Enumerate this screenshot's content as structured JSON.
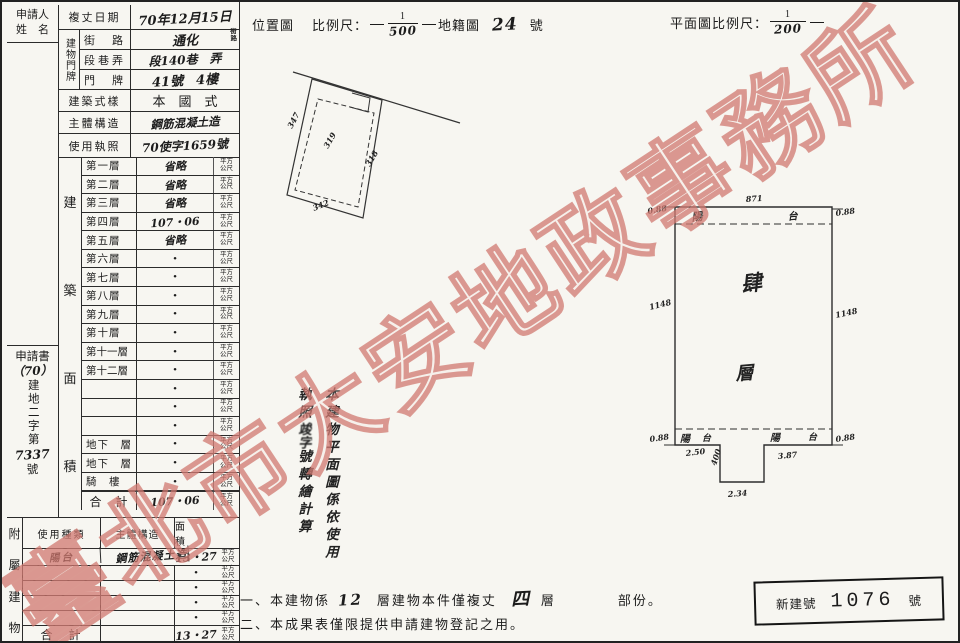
{
  "watermark": {
    "text": "臺北市大安地政事務所",
    "color": "#ce746c"
  },
  "header_table": {
    "applicant_l1": "申請人",
    "applicant_l2": "姓　名",
    "survey_date_label": "複丈日期",
    "survey_date_value": "70年12月15日",
    "doorplate_label": "建物門牌",
    "street_label": "街　路",
    "street_value": "通化",
    "street_unit_l1": "街",
    "street_unit_l2": "路",
    "section_label": "段巷弄",
    "section_value": "段140巷　弄",
    "number_label": "門　牌",
    "number_value": "41號　4樓",
    "style_label": "建築式樣",
    "style_value": "本　國　式",
    "structure_label": "主體構造",
    "structure_value": "鋼筋混凝土造",
    "license_label": "使用執照",
    "license_value": "70使字1659號"
  },
  "application": {
    "line1": "申請書",
    "line2": "（70）",
    "vertical_chars": "建地二字第",
    "number": "7337",
    "suffix": "號"
  },
  "floors_table": {
    "side_label_chars": [
      "建",
      "築",
      "面",
      "積"
    ],
    "unit_l1": "平方",
    "unit_l2": "公尺",
    "rows": [
      {
        "label": "第一層",
        "value": "省略"
      },
      {
        "label": "第二層",
        "value": "省略"
      },
      {
        "label": "第三層",
        "value": "省略"
      },
      {
        "label": "第四層",
        "value": "107・06"
      },
      {
        "label": "第五層",
        "value": "省略"
      },
      {
        "label": "第六層",
        "value": "•"
      },
      {
        "label": "第七層",
        "value": "•"
      },
      {
        "label": "第八層",
        "value": "•"
      },
      {
        "label": "第九層",
        "value": "•"
      },
      {
        "label": "第十層",
        "value": "•"
      },
      {
        "label": "第十一層",
        "value": "•"
      },
      {
        "label": "第十二層",
        "value": "•"
      },
      {
        "label": "",
        "value": "•"
      },
      {
        "label": "",
        "value": "•"
      },
      {
        "label": "",
        "value": "•"
      },
      {
        "label": "地下　層",
        "value": "•"
      },
      {
        "label": "地下　層",
        "value": "•"
      },
      {
        "label": "騎　樓",
        "value": "•"
      }
    ],
    "total_label": "合　計",
    "total_value": "107・06"
  },
  "annex_table": {
    "side_label_chars": [
      "附",
      "屬",
      "建",
      "物"
    ],
    "col_use": "使用種類",
    "col_structure": "主體構造",
    "col_area": "面　　積",
    "rows": [
      {
        "use": "陽台",
        "structure": "鋼筋混凝土造",
        "area": "13・27"
      },
      {
        "use": "",
        "structure": "",
        "area": "•"
      },
      {
        "use": "",
        "structure": "",
        "area": "•"
      },
      {
        "use": "",
        "structure": "",
        "area": "•"
      },
      {
        "use": "",
        "structure": "",
        "area": "•"
      }
    ],
    "total_label": "合　計",
    "total_area": "13・27"
  },
  "location_map": {
    "title": "位置圖",
    "scale_label": "比例尺：",
    "scale_numerator": "1",
    "scale_denominator": "500",
    "cadastre_label": "地籍圖",
    "cadastre_number": "24",
    "cadastre_suffix": "號",
    "parcel_left": "347",
    "parcel_center": "319",
    "parcel_right": "318",
    "parcel_bottom": "342"
  },
  "floor_plan": {
    "scale_label": "平面圖比例尺：",
    "scale_numerator": "1",
    "scale_denominator": "200",
    "dim_top": "871",
    "dim_top_left": "0.88",
    "dim_top_right": "0.88",
    "dim_side_left": "1148",
    "dim_side_right": "1148",
    "dim_bottom_left": "0.88",
    "dim_bottom_right": "0.88",
    "dim_strip_left": "2.50",
    "dim_strip_right": "3.87",
    "dim_protrusion_side": "400",
    "dim_protrusion_bottom": "2.34",
    "balcony_top_left": "陽",
    "balcony_top_right": "台",
    "balcony_bl_1": "陽",
    "balcony_bl_2": "台",
    "balcony_br_1": "陽",
    "balcony_br_2": "台",
    "floor_char_1": "肆",
    "floor_char_2": "層"
  },
  "vertical_note": {
    "col_right": "本建物平面圖係依使用",
    "col_left_prefix": "執照",
    "col_left_scribble": "竣字",
    "col_left_suffix": "號轉繪計算"
  },
  "notes": {
    "n1_p1": "一、本建物係",
    "n1_hand1": "12",
    "n1_p2": "層建物本件僅複丈",
    "n1_hand2": "四",
    "n1_p3": "層",
    "n1_p4": "部份。",
    "line2": "二、本成果表僅限提供申請建物登記之用。"
  },
  "stamp": {
    "label": "新建號",
    "number": "1076",
    "suffix": "號"
  }
}
